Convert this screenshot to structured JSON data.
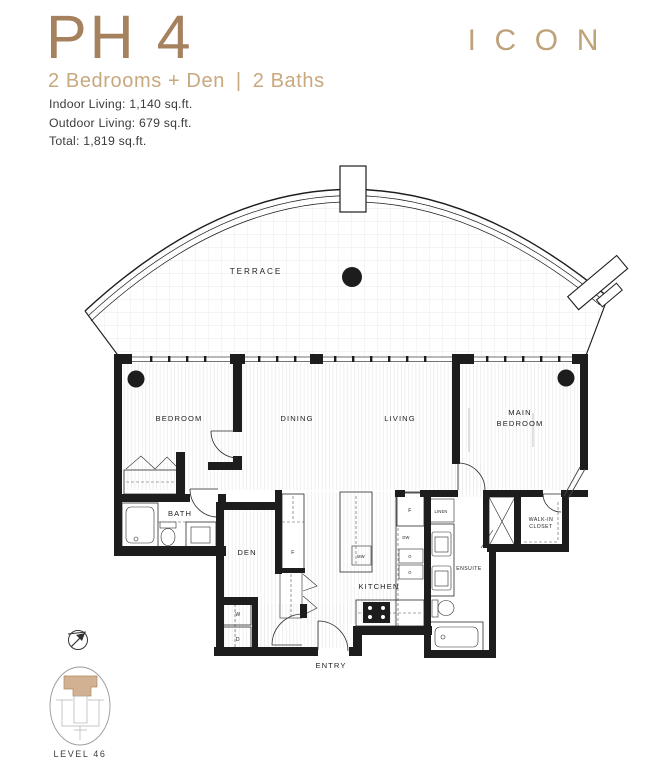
{
  "header": {
    "unit": "PH 4",
    "subtitle_left": "2 Bedrooms + Den",
    "subtitle_sep": "|",
    "subtitle_right": "2 Baths",
    "stats": [
      "Indoor Living: 1,140 sq.ft.",
      "Outdoor Living: 679 sq.ft.",
      "Total: 1,819 sq.ft."
    ]
  },
  "brand": {
    "name": "ICON"
  },
  "plan": {
    "labels": {
      "terrace": "TERRACE",
      "bedroom": "BEDROOM",
      "dining": "DINING",
      "living": "LIVING",
      "main_bedroom_line1": "MAIN",
      "main_bedroom_line2": "BEDROOM",
      "bath": "BATH",
      "den": "DEN",
      "kitchen": "KITCHEN",
      "entry": "ENTRY",
      "ensuite": "ENSUITE",
      "linen": "LINEN",
      "walkin_line1": "WALK-IN",
      "walkin_line2": "CLOSET"
    },
    "appliances": {
      "washer": "W",
      "dryer": "D",
      "fridge": "F",
      "dishwasher": "DW",
      "microwave": "MW",
      "oven": "O"
    }
  },
  "keyplan": {
    "label": "LEVEL 46"
  },
  "colors": {
    "accent_dark": "#a6815e",
    "accent": "#c8a87e",
    "logo": "#bda27a",
    "ink": "#1d1d1d",
    "keyplan_fill": "#d2b192"
  }
}
